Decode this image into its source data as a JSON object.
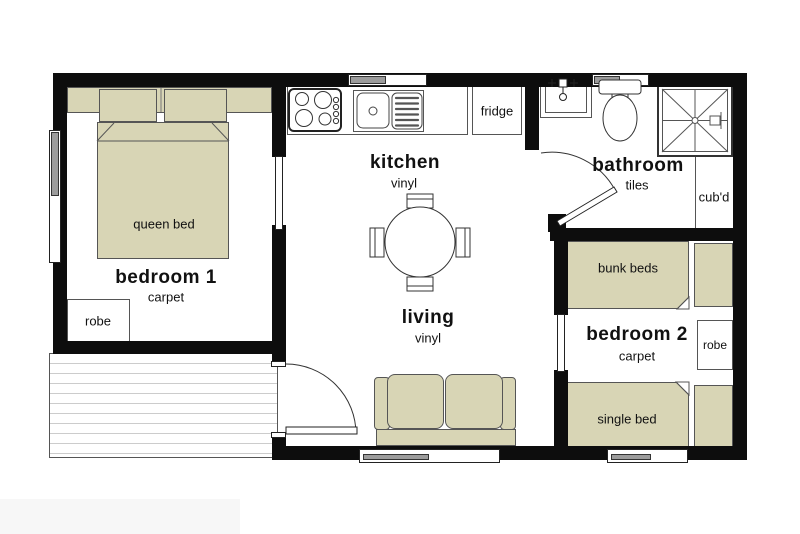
{
  "title": "cabin floor plan",
  "colors": {
    "wall": "#0d0d0d",
    "furniture_fill": "#d8d5b5",
    "outline": "#555555",
    "window_gray": "#9c9c9c",
    "deck_line": "#cccccc",
    "background": "#ffffff"
  },
  "rooms": {
    "bedroom1": {
      "label": "bedroom 1",
      "floor": "carpet"
    },
    "kitchen": {
      "label": "kitchen",
      "floor": "vinyl"
    },
    "living": {
      "label": "living",
      "floor": "vinyl"
    },
    "bathroom": {
      "label": "bathroom",
      "floor": "tiles"
    },
    "bedroom2": {
      "label": "bedroom 2",
      "floor": "carpet"
    }
  },
  "furniture": {
    "queen_bed": "queen bed",
    "robe1": "robe",
    "fridge": "fridge",
    "cupboard": "cub'd",
    "bunk_beds": "bunk beds",
    "robe2": "robe",
    "single_bed": "single bed"
  }
}
